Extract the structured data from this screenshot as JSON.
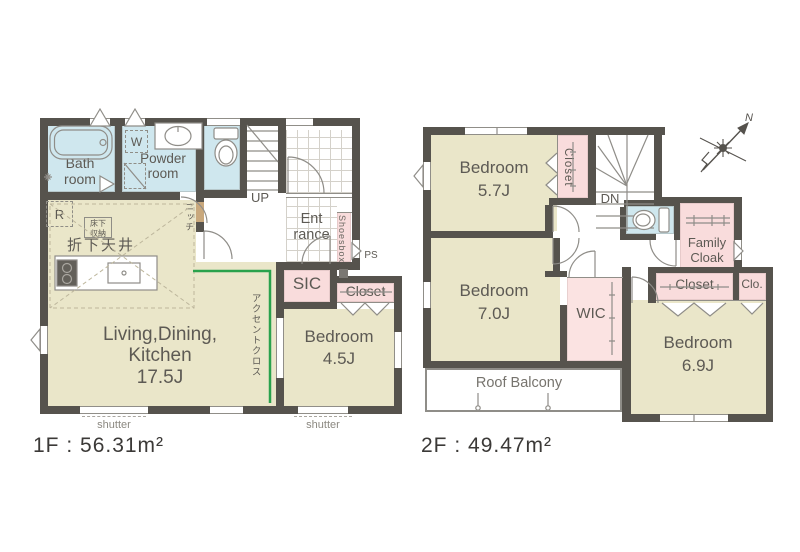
{
  "floor1": {
    "area_label": "1F : 56.31m²",
    "rooms": {
      "bath_l1": "Bath",
      "bath_l2": "room",
      "powder_l1": "Powder",
      "powder_l2": "room",
      "washer": "W",
      "fridge": "R",
      "underfloor_l1": "床下",
      "underfloor_l2": "収納",
      "dropped_ceiling": "折下天井",
      "niche": "ニッチ",
      "up": "UP",
      "entrance_l1": "Ent",
      "entrance_l2": "rance",
      "shoesbox": "Shoesbox",
      "ps": "PS",
      "sic": "SIC",
      "closet": "Closet",
      "ldk_l1": "Living,Dining,",
      "ldk_l2": "Kitchen",
      "ldk_size": "17.5J",
      "accent_cloth": "アクセントクロス",
      "bedroom": "Bedroom",
      "bedroom_size": "4.5J",
      "shutter_left": "shutter",
      "shutter_right": "shutter"
    }
  },
  "floor2": {
    "area_label": "2F : 49.47m²",
    "compass_north": "N",
    "rooms": {
      "bedroom1": "Bedroom",
      "bedroom1_size": "5.7J",
      "closet_top": "Closet",
      "dn": "DN",
      "family_l1": "Family",
      "family_l2": "Cloak",
      "bedroom2": "Bedroom",
      "bedroom2_size": "7.0J",
      "wic": "WIC",
      "closet_mid": "Closet",
      "clo": "Clo.",
      "bedroom3": "Bedroom",
      "bedroom3_size": "6.9J",
      "roof_balcony": "Roof Balcony"
    }
  },
  "colors": {
    "wall": "#56534d",
    "room_beige": "#eae6c9",
    "wet_area_blue": "#cfe7ee",
    "storage_pink": "#f9dcdc",
    "accent_green": "#2aa24c"
  }
}
